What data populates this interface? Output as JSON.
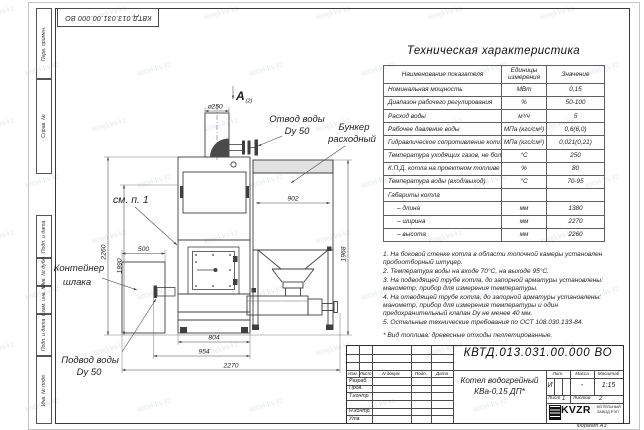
{
  "sheet": {
    "stamp_top": "КВТД.013.031.00.000 ВО",
    "format_note": "Формат А3",
    "watermark": "kotel-kv.kz",
    "sidebar": [
      "Перв. примен.",
      "Справ. №",
      "Подп. и дата",
      "Инв. № дубл.",
      "Взам. инв. №",
      "Подп. и дата",
      "Инв. № подл."
    ]
  },
  "spec_table": {
    "title": "Техническая характеристика",
    "headers": [
      "Наименование показателя",
      "Единицы измерения",
      "Значение"
    ],
    "rows": [
      [
        "Номинальная мощность",
        "МВт",
        "0,15"
      ],
      [
        "Диапазон рабочего регулирования",
        "%",
        "50-100"
      ],
      [
        "Расход воды",
        "м³/ч",
        "5"
      ],
      [
        "Рабочее давление воды",
        "МПа (кгс/см²)",
        "0,6(6,0)"
      ],
      [
        "Гидравлическое сопротивление котла",
        "МПа (кгс/см²)",
        "0,021(0,21)"
      ],
      [
        "Температура уходящих газов, не более",
        "°С",
        "250"
      ],
      [
        "К.П.Д. котла на проектном топливе",
        "%",
        "80"
      ],
      [
        "Температура воды (вход/выход)",
        "°С",
        "70-95"
      ],
      [
        "Габариты котла",
        "",
        ""
      ],
      [
        "– длина",
        "мм",
        "1380"
      ],
      [
        "– ширина",
        "мм",
        "2270"
      ],
      [
        "– высота",
        "мм",
        "2260"
      ]
    ]
  },
  "notes": [
    "1. На боковой стенке котла в области топочной камеры установлен пробоотборный штуцер.",
    "2. Температура воды на входе 70°С, на выходе 95°С.",
    "3. На подводящей трубе котла, до запорной арматуры установлены: манометр, прибор для измерения температуры.",
    "4. На отводящей трубе котла, до запорной арматуры установлены: манометр, прибор для измерения температуры и один предохранительный клапан Dу не менее 40 мм.",
    "5. Остальные технические требования по ОСТ 108.030.133-84."
  ],
  "fuel_note": "* Вид топлива: древесные отходы пеллетированные.",
  "drawing": {
    "view_label": "А",
    "view_ref": "(2)",
    "labels": {
      "outlet_1": "Отвод воды",
      "outlet_2": "Dy 50",
      "bunker_1": "Бункер",
      "bunker_2": "расходный",
      "see_note": "см. п. 1",
      "slag_1": "Контейнер",
      "slag_2": "шлака",
      "inlet_1": "Подвод воды",
      "inlet_2": "Dy 50"
    },
    "dims": {
      "chimney": "⌀250",
      "bunker_width": "902",
      "slag_width": "500",
      "boiler_width": "804",
      "inlet_width": "954",
      "total_width": "2270",
      "total_height": "2260",
      "height_1990": "1990",
      "bunker_height": "1968"
    }
  },
  "title_block": {
    "doc_number": "КВТД.013.031.00.000 ВО",
    "product_name_1": "Котел водогрейный",
    "product_name_2": "КВа-0,15 ДП*",
    "header_cols": [
      "Изм.",
      "Лист",
      "N докум.",
      "Подп.",
      "Дата"
    ],
    "staff_rows": [
      "Разраб.",
      "Пров.",
      "Т.контр.",
      "Н.контр.",
      "Утв."
    ],
    "lit_label": "Лит.",
    "mass_label": "Масса",
    "scale_label": "Масштаб",
    "lit_value": "И",
    "mass_value": "-",
    "scale_value": "1:15",
    "sheet_label": "Лист",
    "sheet_value": "1",
    "sheets_label": "Листов",
    "sheets_value": "2",
    "logo_text": "KVZR",
    "company_1": "КОТЕЛЬНЫЙ",
    "company_2": "ЗАВОД РЭП"
  }
}
